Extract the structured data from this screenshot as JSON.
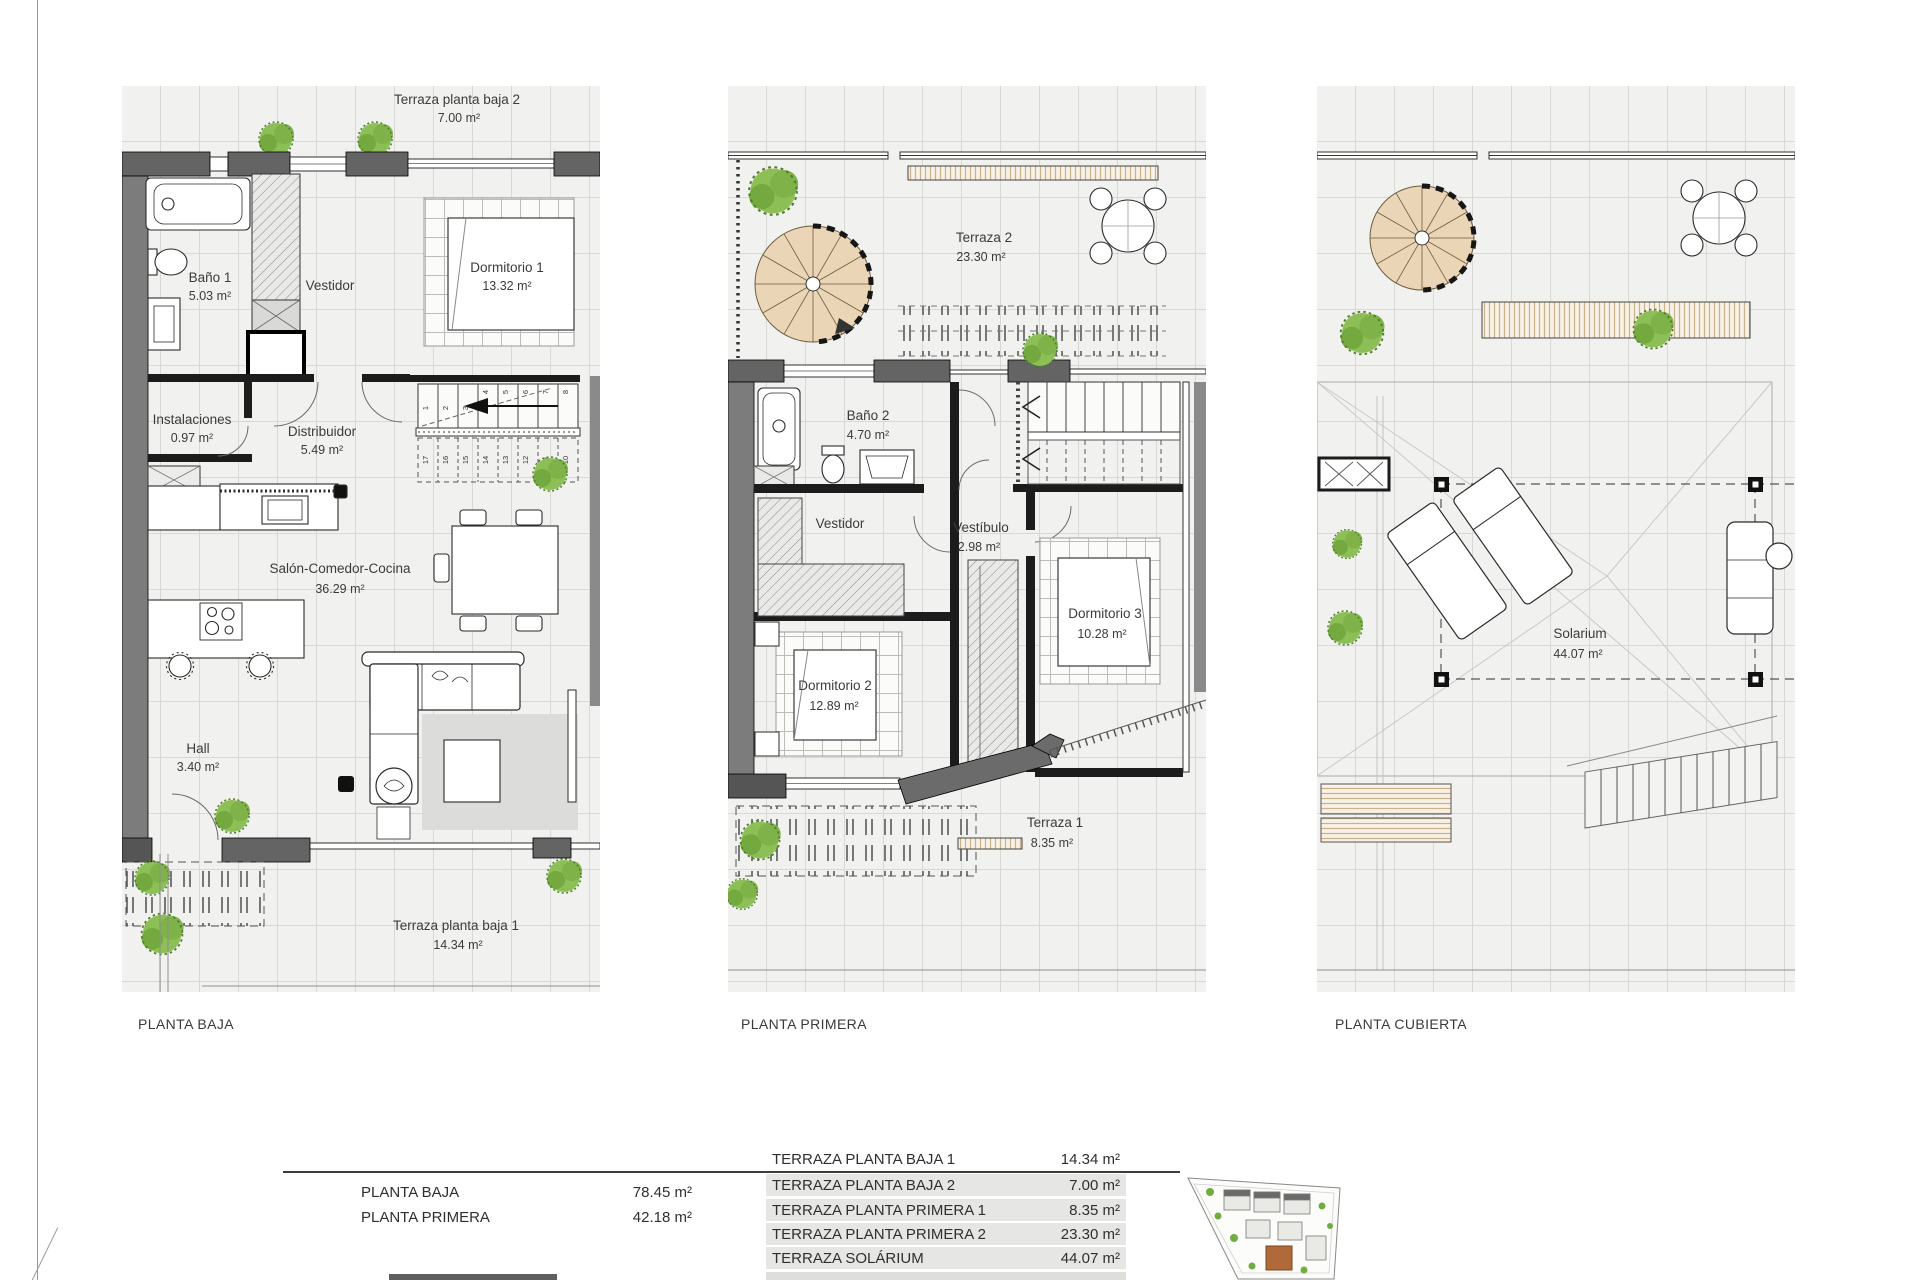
{
  "plans": [
    {
      "caption": "PLANTA BAJA",
      "rooms": {
        "terraza_alta": {
          "name": "Terraza planta baja 2",
          "area": "7.00 m²"
        },
        "bano": {
          "name": "Baño 1",
          "area": "5.03 m²"
        },
        "vestidor": {
          "name": "Vestidor"
        },
        "dormitorio": {
          "name": "Dormitorio 1",
          "area": "13.32 m²"
        },
        "instalaciones": {
          "name": "Instalaciones",
          "area": "0.97 m²"
        },
        "distribuidor": {
          "name": "Distribuidor",
          "area": "5.49 m²"
        },
        "salon": {
          "name": "Salón-Comedor-Cocina",
          "area": "36.29 m²"
        },
        "hall": {
          "name": "Hall",
          "area": "3.40 m²"
        },
        "terraza_baja": {
          "name": "Terraza planta baja 1",
          "area": "14.34 m²"
        }
      },
      "stairs_up": [
        "1",
        "2",
        "3",
        "4",
        "5",
        "6",
        "7",
        "8"
      ],
      "stairs_down": [
        "17",
        "16",
        "15",
        "14",
        "13",
        "12",
        "11",
        "10"
      ]
    },
    {
      "caption": "PLANTA PRIMERA",
      "rooms": {
        "terraza2": {
          "name": "Terraza 2",
          "area": "23.30 m²"
        },
        "bano2": {
          "name": "Baño 2",
          "area": "4.70 m²"
        },
        "vestidor": {
          "name": "Vestidor"
        },
        "vestibulo": {
          "name": "Vestíbulo",
          "area": "2.98 m²"
        },
        "dormitorio2": {
          "name": "Dormitorio 2",
          "area": "12.89 m²"
        },
        "dormitorio3": {
          "name": "Dormitorio 3",
          "area": "10.28 m²"
        },
        "terraza1": {
          "name": "Terraza 1",
          "area": "8.35 m²"
        }
      }
    },
    {
      "caption": "PLANTA CUBIERTA",
      "rooms": {
        "solarium": {
          "name": "Solarium",
          "area": "44.07 m²"
        }
      }
    }
  ],
  "summary": {
    "main": [
      {
        "label": "PLANTA BAJA",
        "value": "78.45 m²"
      },
      {
        "label": "PLANTA PRIMERA",
        "value": "42.18 m²"
      }
    ],
    "terraces": [
      {
        "label": "TERRAZA PLANTA BAJA 1",
        "value": "14.34 m²"
      },
      {
        "label": "TERRAZA PLANTA BAJA 2",
        "value": "7.00 m²"
      },
      {
        "label": "TERRAZA PLANTA PRIMERA 1",
        "value": "8.35 m²"
      },
      {
        "label": "TERRAZA PLANTA PRIMERA 2",
        "value": "23.30 m²"
      },
      {
        "label": "TERRAZA SOLÁRIUM",
        "value": "44.07 m²"
      }
    ]
  }
}
